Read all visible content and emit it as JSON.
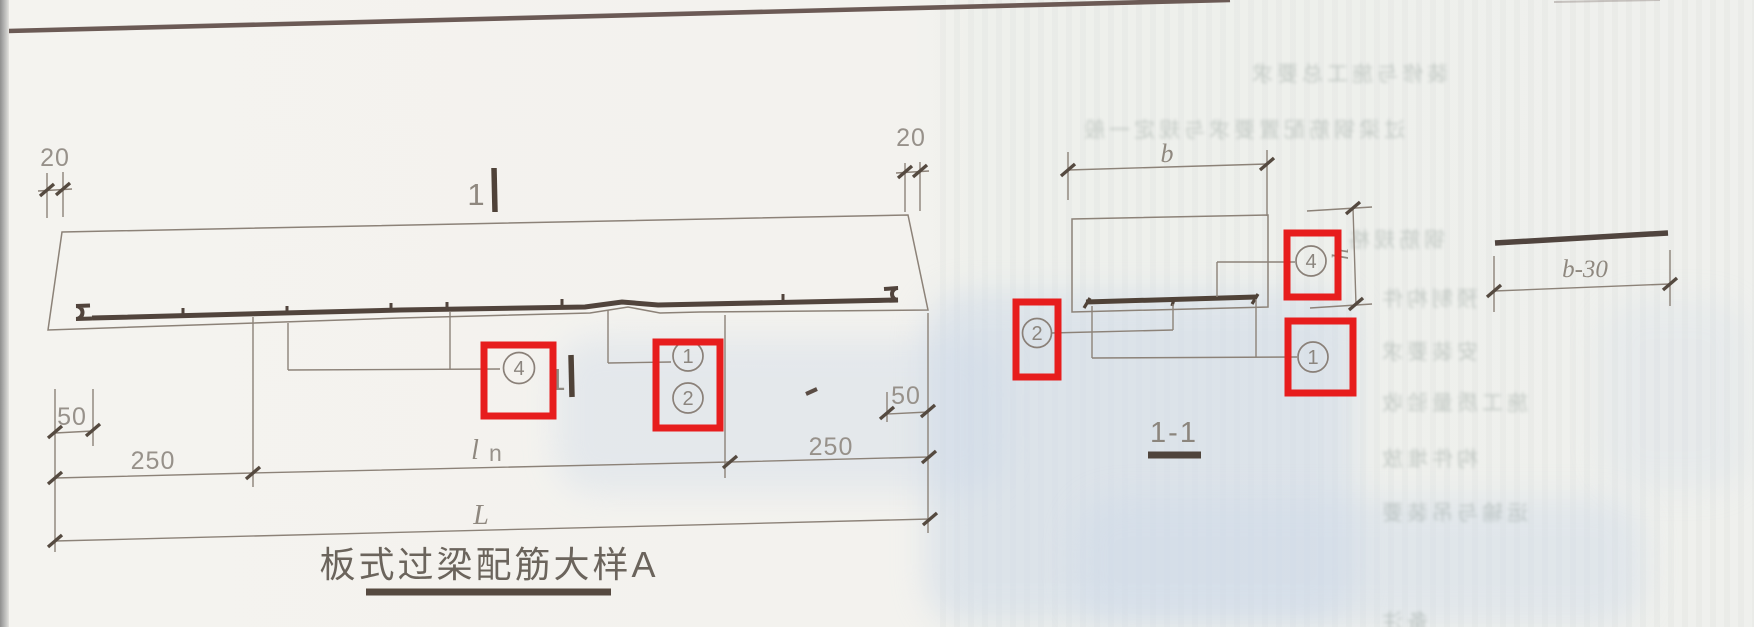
{
  "meta": {
    "description": "Scanned construction detail page: slab-type lintel reinforcement detail A with section 1-1; red boxes highlight rebar callouts"
  },
  "colors": {
    "paper_left": "#f3f2ee",
    "paper_right": "#eef0ed",
    "thin_line": "#8c8278",
    "thick_line": "#4f4238",
    "dim_text": "#97918a",
    "red_highlight": "#e71d1d",
    "title_text": "#6b645c",
    "blue_wash": "#ccd8e8",
    "scan_edge_line": "#6b5a55"
  },
  "elevation": {
    "title": "板式过梁配筋大样A",
    "dim_20_left": "20",
    "dim_20_right": "20",
    "dim_50_left": "50",
    "dim_50_right": "50",
    "dim_250_left": "250",
    "dim_250_right": "250",
    "dim_ln_main": "l",
    "dim_ln_sub": "n",
    "dim_L": "L",
    "section_marker_top": "1",
    "section_marker_bottom": "1",
    "callout_4": "4",
    "callout_1": "1",
    "callout_2": "2"
  },
  "section": {
    "title": "1-1",
    "dim_b": "b",
    "dim_h": "h",
    "callout_4": "4",
    "callout_1": "1",
    "callout_2": "2"
  },
  "bar_detail": {
    "dim_b30": "b-30"
  },
  "bleed_through": {
    "note": "illegible mirrored print-through from reverse side of page",
    "rows": [
      {
        "text": "装修与施工总要求"
      },
      {
        "text": "过梁钢筋配置要求与规定一般"
      },
      {
        "text": "钢筋规格"
      },
      {
        "text": "预制构件"
      },
      {
        "text": "安装要求"
      },
      {
        "text": "施工质量验收"
      },
      {
        "text": "构件堆放"
      },
      {
        "text": "运输与吊装要"
      },
      {
        "text": "备注"
      }
    ]
  }
}
